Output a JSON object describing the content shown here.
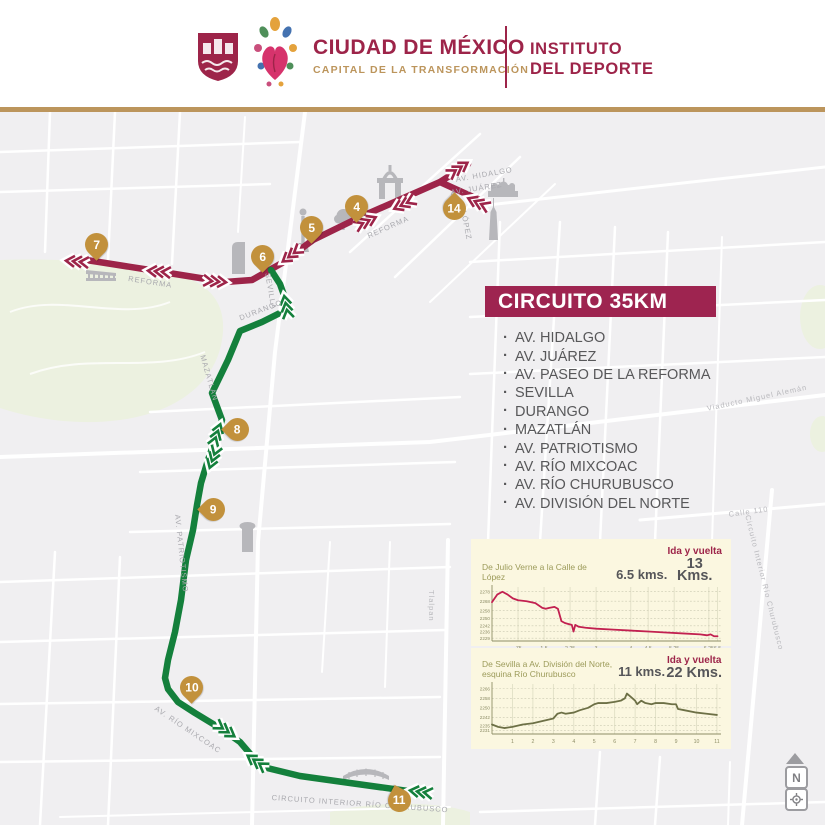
{
  "header": {
    "brand_title": "CIUDAD DE MÉXICO",
    "brand_subtitle": "CAPITAL DE LA TRANSFORMACIÓN",
    "institute_line1": "INSTITUTO",
    "institute_line2": "DEL DEPORTE"
  },
  "colors": {
    "maroon": "#9d2449",
    "gold": "#bc955c",
    "marker_gold": "#c2913c",
    "route_red": "#9d2449",
    "route_green": "#14803c",
    "panel_cream": "#fbf7e0"
  },
  "circuit": {
    "banner": "CIRCUITO  35KM",
    "streets": [
      "AV. HIDALGO",
      "AV. JUÁREZ",
      "AV. PASEO DE LA REFORMA",
      "SEVILLA",
      "DURANGO",
      "MAZATLÁN",
      "AV. PATRIOTISMO",
      "AV. RÍO MIXCOAC",
      "AV. RÍO CHURUBUSCO",
      "AV. DIVISIÓN DEL NORTE"
    ]
  },
  "map": {
    "markers": {
      "k4": "4",
      "k5": "5",
      "k6": "6",
      "k7": "7",
      "k8": "8",
      "k9": "9",
      "k10": "10",
      "k11": "11",
      "k14": "14"
    },
    "street_labels": {
      "reforma_west": "REFORMA",
      "reforma_center": "REFORMA",
      "sevilla": "SEVILLA",
      "durango": "DURANGO",
      "mazatlan": "MAZATLÁN",
      "patriotismo": "AV. PATRIOTISMO",
      "mixcoac": "AV. RÍO MIXCOAC",
      "churubusco": "CIRCUITO INTERIOR RÍO CHURUBUSCO",
      "hidalgo": "AV. HIDALGO",
      "juarez": "AV. JUÁREZ",
      "lopez": "LÓPEZ",
      "tlalpan": "Tlalpan",
      "calle110": "Calle 110",
      "churubusco_right": "Circuito Interior Río Churubusco",
      "viaducto": "Viaducto Miguel Alemán"
    },
    "controls": {
      "north_label": "N"
    }
  },
  "chart_data": [
    {
      "type": "line",
      "title": "De Julio Verne a la Calle de López",
      "distance": "6.5 kms.",
      "roundtrip_label": "Ida y vuelta",
      "roundtrip": "13 Kms.",
      "line_color": "#c22050",
      "xlim": [
        0,
        6.6
      ],
      "ylim": [
        2226,
        2283
      ],
      "yticks": [
        2278,
        2268,
        2258,
        2250,
        2242,
        2236,
        2229
      ],
      "xticks": [
        {
          "v": 0.75,
          "label": ".75"
        },
        {
          "v": 1.5,
          "label": "1.5"
        },
        {
          "v": 2.25,
          "label": "2.25"
        },
        {
          "v": 3,
          "label": "3"
        },
        {
          "v": 4,
          "label": "4"
        },
        {
          "v": 4.5,
          "label": "4.5"
        },
        {
          "v": 5.25,
          "label": "5.25"
        },
        {
          "v": 6.25,
          "label": "6.25"
        },
        {
          "v": 6.5,
          "label": "6.5"
        }
      ],
      "x": [
        0,
        0.15,
        0.3,
        0.45,
        0.6,
        0.75,
        1.0,
        1.25,
        1.45,
        1.55,
        1.65,
        1.8,
        1.9,
        2.0,
        2.1,
        2.2,
        2.3,
        2.35,
        2.4,
        2.5,
        2.7,
        3.0,
        3.5,
        4.0,
        4.5,
        5.0,
        5.5,
        6.0,
        6.2,
        6.3,
        6.4,
        6.5
      ],
      "y": [
        2267,
        2275,
        2278,
        2275,
        2271,
        2269,
        2268,
        2266,
        2261,
        2260,
        2261,
        2262,
        2260,
        2247,
        2245,
        2244,
        2243,
        2236,
        2243,
        2241,
        2240,
        2239,
        2238,
        2237,
        2236,
        2235,
        2234,
        2233,
        2232,
        2233,
        2231,
        2231
      ]
    },
    {
      "type": "line",
      "title": "De Sevilla a Av. División del Norte,",
      "title2": "esquina Río Churubusco",
      "distance": "11 kms.",
      "roundtrip_label": "Ida y vuelta",
      "roundtrip": "22 Kms.",
      "line_color": "#6d7046",
      "xlim": [
        0,
        11.2
      ],
      "ylim": [
        2228,
        2270
      ],
      "yticks": [
        2266,
        2258,
        2250,
        2242,
        2235,
        2231
      ],
      "xticks": [
        {
          "v": 1,
          "label": "1"
        },
        {
          "v": 2,
          "label": "2"
        },
        {
          "v": 3,
          "label": "3"
        },
        {
          "v": 4,
          "label": "4"
        },
        {
          "v": 5,
          "label": "5"
        },
        {
          "v": 6,
          "label": "6"
        },
        {
          "v": 7,
          "label": "7"
        },
        {
          "v": 8,
          "label": "8"
        },
        {
          "v": 9,
          "label": "9"
        },
        {
          "v": 10,
          "label": "10"
        },
        {
          "v": 11,
          "label": "11"
        }
      ],
      "x": [
        0,
        0.3,
        0.6,
        1,
        1.5,
        2,
        2.5,
        3,
        3.2,
        3.4,
        3.6,
        4,
        4.3,
        4.7,
        5,
        5.2,
        5.6,
        6,
        6.3,
        6.5,
        6.6,
        6.8,
        7,
        7.1,
        7.3,
        7.5,
        7.8,
        8,
        8.4,
        8.8,
        9,
        9.1,
        9.4,
        10,
        10.5,
        11
      ],
      "y": [
        2236,
        2234,
        2233,
        2234,
        2236,
        2237,
        2239,
        2241,
        2245,
        2246,
        2245,
        2246,
        2248,
        2250,
        2253,
        2254,
        2254,
        2255,
        2256,
        2258,
        2262,
        2259,
        2256,
        2253,
        2256,
        2254,
        2253,
        2254,
        2254,
        2253,
        2253,
        2249,
        2248,
        2246,
        2245,
        2244
      ]
    }
  ]
}
